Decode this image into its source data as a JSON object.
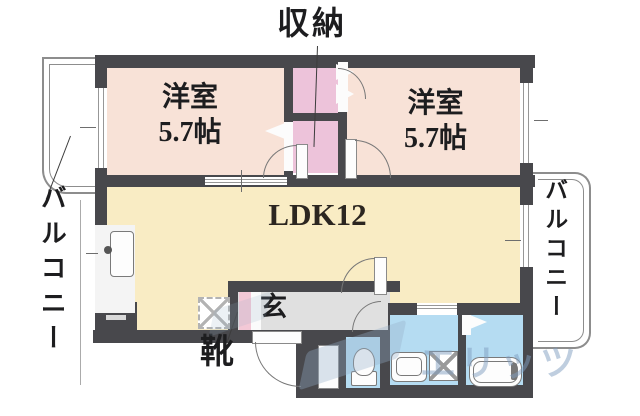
{
  "plan": {
    "storage_label": "収納",
    "bedroom_left": {
      "type": "洋室",
      "size": "5.7帖"
    },
    "bedroom_right": {
      "type": "洋室",
      "size": "5.7帖"
    },
    "ldk_label": "LDK12",
    "balcony_left_label": "バルコニー",
    "balcony_right_label": "バルコニー",
    "entrance_label": "玄",
    "shoes_label": "靴",
    "watermark": "エリッツ",
    "colors": {
      "wall": "#48484c",
      "bedroom": "#f8e2d7",
      "closet": "#edc3da",
      "ldk": "#f9ecc4",
      "wet_room": "#b5dcf2",
      "entrance_floor": "#e0e0e0",
      "shoe_cabinet": "#f3c8d6",
      "balcony_rail": "#8d8d8d",
      "watermark": "#809ec0"
    }
  }
}
